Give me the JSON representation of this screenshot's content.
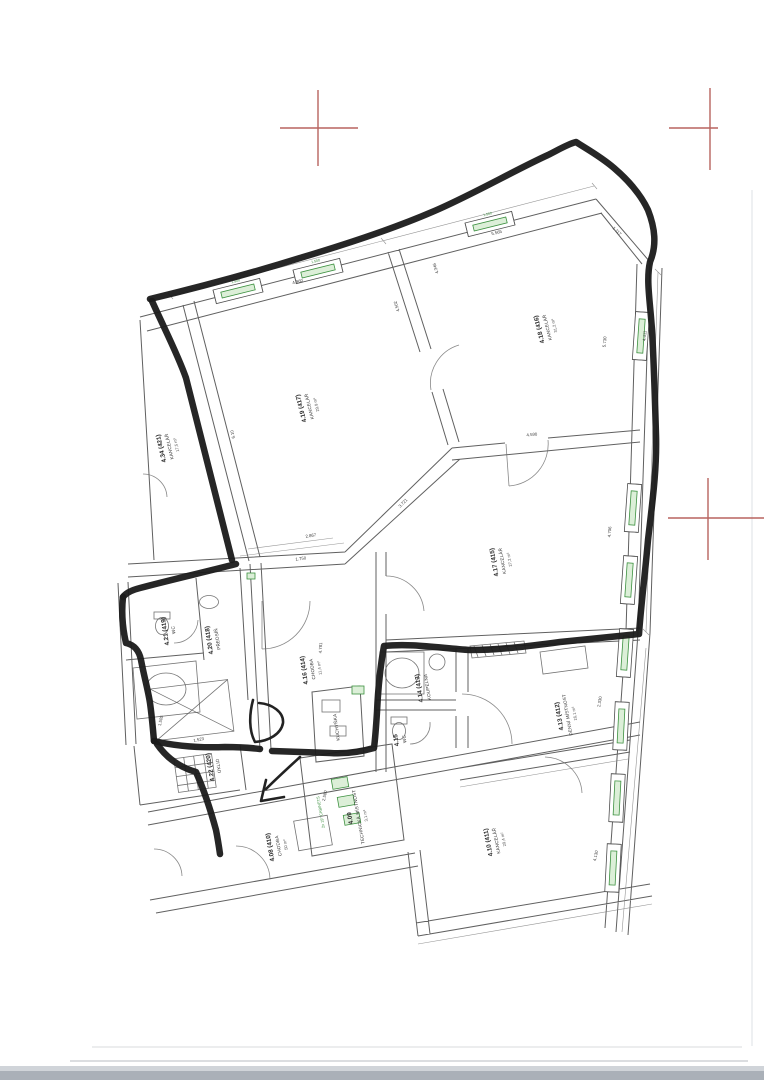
{
  "page": {
    "kind": "scanned architectural floor plan with hand-drawn marker selection"
  },
  "colors": {
    "paper": "#ffffff",
    "ink": "#4f4f4f",
    "marker": "#1a1a1a",
    "window_green": "#3d9140",
    "window_green_fill": "#dcefd8",
    "registration_red": "#b0534e",
    "scan_gray": "#aab0b8"
  },
  "rooms": [
    {
      "id": "4.34 (421)",
      "name": "KANCELÁŘ",
      "area": "17,5 m²"
    },
    {
      "id": "4.19 (417)",
      "name": "KANCELÁŘ",
      "area": "29,9 m²"
    },
    {
      "id": "4.18 (416)",
      "name": "KANCELÁŘ",
      "area": "31,2 m²"
    },
    {
      "id": "4.17 (415)",
      "name": "KANCELÁŘ",
      "area": "27,2 m²"
    },
    {
      "id": "4.21 (419)",
      "name": "WC",
      "area": ""
    },
    {
      "id": "4.20 (418)",
      "name": "PŘEDSÍŇ",
      "area": ""
    },
    {
      "id": "4.16 (414)",
      "name": "CHODBA",
      "area": "11,4 m²"
    },
    {
      "id": "",
      "name": "KUCHYŇKA",
      "area": ""
    },
    {
      "id": "4.14 (413)",
      "name": "KOUPELNA",
      "area": ""
    },
    {
      "id": "4.15",
      "name": "WC",
      "area": ""
    },
    {
      "id": "4.13 (412)",
      "name": "DENNÍ MÍSTNOST",
      "area": "16,1 m²"
    },
    {
      "id": "4.22 (420)",
      "name": "ÚKLID",
      "area": ""
    },
    {
      "id": "4.09",
      "name": "TECHNICKÁ MÍSTNOST",
      "area": "3,1 m²"
    },
    {
      "id": "4.08 (410)",
      "name": "CHODBA",
      "area": "50 m²"
    },
    {
      "id": "4.10 (411)",
      "name": "KANCELÁŘ",
      "area": "29,4 m²"
    }
  ],
  "dimensions": [
    "4.960",
    "5.565",
    "1.117",
    "6.10",
    "5.730",
    "4.411",
    "4.502",
    "4.346",
    "3.721",
    "2.867",
    "4.590",
    "4.706",
    "1.750",
    "4.781",
    "2.330",
    "4.130",
    "1.505",
    "1.523",
    "2.580"
  ],
  "window_label": "1.500",
  "annotations": {
    "equipment": "2x 19\" CABINETS"
  }
}
